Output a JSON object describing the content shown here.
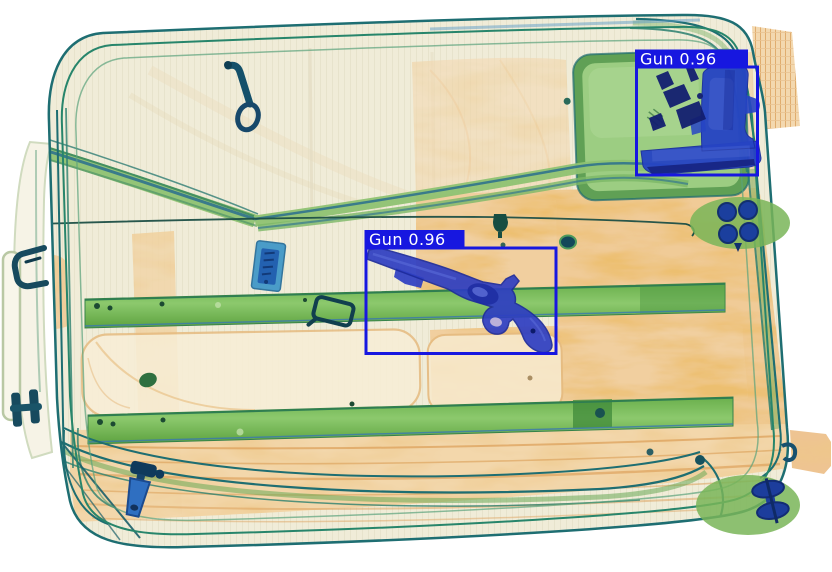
{
  "scene": {
    "type": "xray-baggage-scan",
    "subject": "suitcase"
  },
  "detections": [
    {
      "label": "Gun",
      "confidence": "0.96",
      "display_text": "Gun 0.96",
      "position": "center"
    },
    {
      "label": "Gun",
      "confidence": "0.96",
      "display_text": "Gun 0.96",
      "position": "top-right"
    }
  ],
  "overlay_style": {
    "box_color": "#1717e0",
    "label_background": "#1717e0",
    "label_text_color": "#ffffff"
  },
  "palette": {
    "background": "#ffffff",
    "organic_orange": "#e3a258",
    "fabric_cream": "#f0ecd8",
    "metal_green": "#7ab558",
    "dense_blue": "#2644c4",
    "frame_teal": "#1e6e72"
  }
}
